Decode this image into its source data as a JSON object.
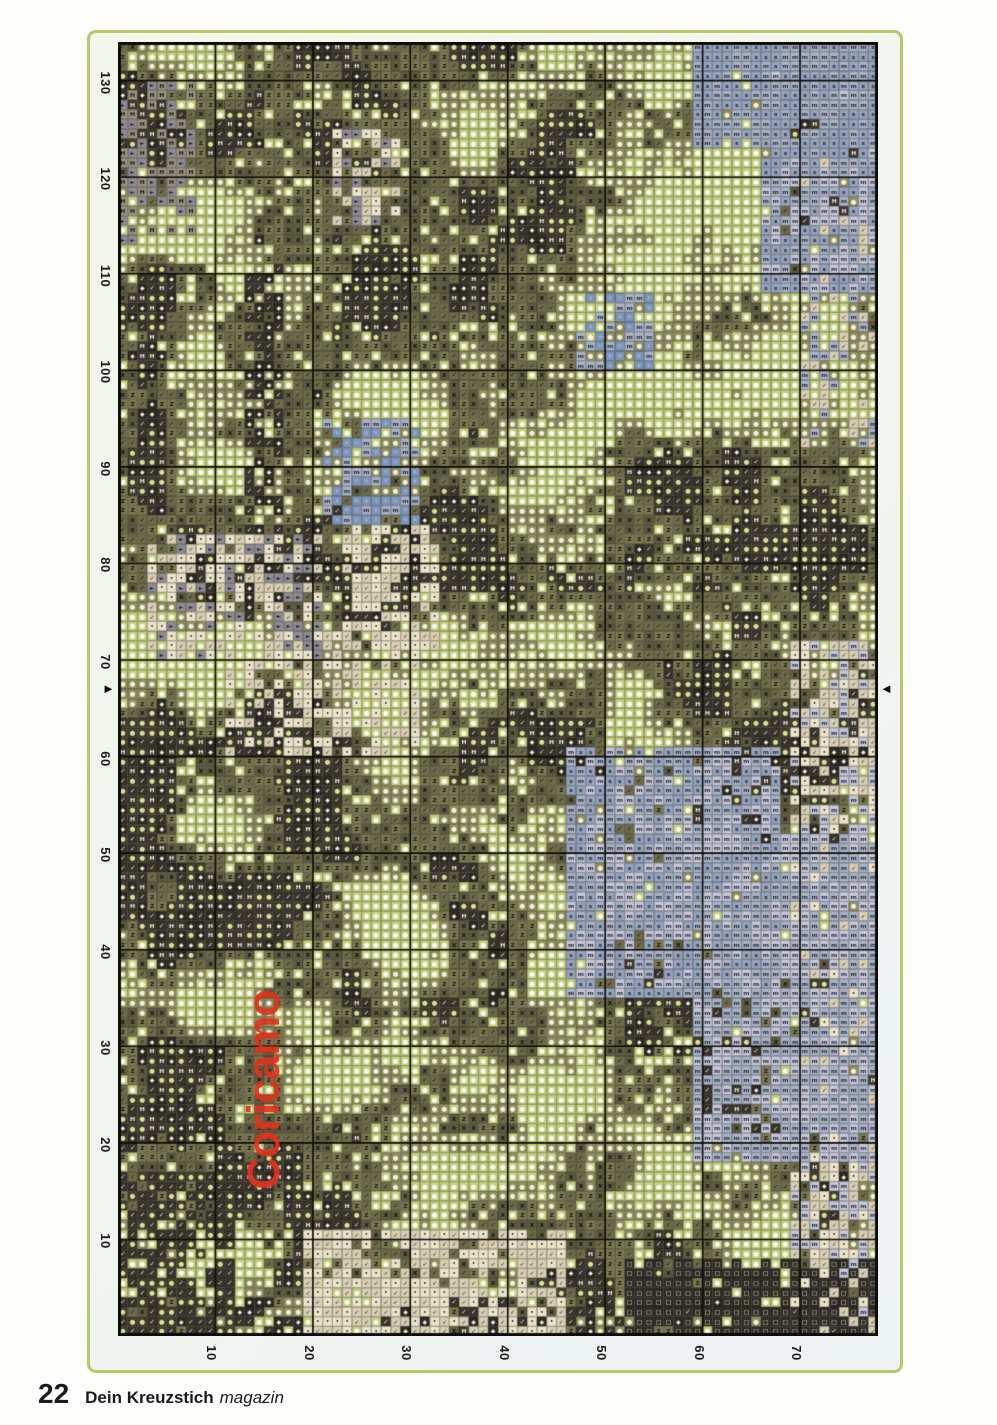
{
  "page": {
    "footer": {
      "number": "22",
      "title": "Dein Kreuzstich",
      "suffix": "magazin"
    }
  },
  "frame": {
    "border_color": "#b5cb67"
  },
  "watermark": {
    "text": "Coricamo",
    "color": "#e2301b"
  },
  "chart": {
    "rows": 134,
    "cols": 78,
    "row_labels": [
      "130",
      "120",
      "110",
      "100",
      "90",
      "80",
      "70",
      "60",
      "50",
      "40",
      "30",
      "20",
      "10"
    ],
    "col_labels": [
      "10",
      "20",
      "30",
      "40",
      "50",
      "60",
      "70"
    ],
    "center_row": 67,
    "center_marker_left": "►",
    "center_marker_right": "◄",
    "grid_color": "#0d0d08",
    "seed": 11,
    "palette": [
      {
        "bg": "#37332a",
        "fg": "#efeadb",
        "sym": "✓",
        "fs": 6.5
      },
      {
        "bg": "#2c2922",
        "fg": "#efeadb",
        "sym": "◆",
        "fs": 6
      },
      {
        "bg": "#433e2e",
        "fg": "#d9e49a",
        "sym": "●",
        "fs": 6.5
      },
      {
        "bg": "#6d6b49",
        "fg": "#14120d",
        "sym": "✓",
        "fs": 6.5
      },
      {
        "bg": "#7b7952",
        "fg": "#14120d",
        "sym": "Z",
        "fs": 6
      },
      {
        "bg": "#5d5b40",
        "fg": "#14120d",
        "sym": "X",
        "fs": 6
      },
      {
        "bg": "#91905f",
        "fg": "#f3f3df",
        "sym": "●",
        "fs": 6.5
      },
      {
        "bg": "#c5d17e",
        "fg": "#ffffff",
        "sym": "●",
        "fs": 6.5
      },
      {
        "bg": "#8d8a92",
        "fg": "#191820",
        "sym": "►",
        "fs": 5.5
      },
      {
        "bg": "#a9b2c6",
        "fg": "#23293a",
        "sym": "m",
        "fs": 6
      },
      {
        "bg": "#c6c7d9",
        "fg": "#23293a",
        "sym": "m",
        "fs": 6
      },
      {
        "bg": "#96a3bd",
        "fg": "#1d2433",
        "sym": "s",
        "fs": 6
      },
      {
        "bg": "#ebe3ca",
        "fg": "#2a261d",
        "sym": "•",
        "fs": 5
      },
      {
        "bg": "#d8cfb4",
        "fg": "#2a261d",
        "sym": "✓",
        "fs": 6
      },
      {
        "bg": "#7e95ba",
        "fg": "#f0f2f6",
        "sym": "◦",
        "fs": 6
      },
      {
        "bg": "#9a9280",
        "fg": "#15130f",
        "sym": "H",
        "fs": 6
      },
      {
        "bg": "#2e2b24",
        "fg": "#f5f2e8",
        "sym": "□",
        "fs": 6
      },
      {
        "bg": "#3d382e",
        "fg": "#efeadb",
        "sym": "H",
        "fs": 6
      }
    ],
    "regions": [
      {
        "c0": 52,
        "r0": 126,
        "c1": 78,
        "r1": 134,
        "d": 0.8,
        "p": [
          16
        ]
      },
      {
        "c0": 0,
        "r0": 117,
        "c1": 12,
        "r1": 134,
        "d": 0.7,
        "p": [
          2,
          0
        ]
      },
      {
        "c0": 59,
        "r0": 0,
        "c1": 78,
        "r1": 11,
        "d": 0.9,
        "p": [
          9,
          11
        ]
      },
      {
        "c0": 66,
        "r0": 0,
        "c1": 78,
        "r1": 26,
        "d": 0.85,
        "p": [
          9,
          11,
          10
        ]
      },
      {
        "c0": 46,
        "r0": 73,
        "c1": 68,
        "r1": 99,
        "d": 0.85,
        "p": [
          10,
          9,
          11
        ]
      },
      {
        "c0": 59,
        "r0": 82,
        "c1": 78,
        "r1": 116,
        "d": 0.8,
        "p": [
          10,
          9
        ]
      },
      {
        "c0": 69,
        "r0": 62,
        "c1": 78,
        "r1": 134,
        "d": 0.7,
        "p": [
          12,
          13,
          10
        ]
      },
      {
        "c0": 19,
        "r0": 123,
        "c1": 46,
        "r1": 134,
        "d": 0.75,
        "p": [
          12,
          13
        ]
      },
      {
        "c0": 3,
        "r0": 51,
        "c1": 21,
        "r1": 64,
        "d": 0.6,
        "p": [
          12,
          13,
          8
        ]
      },
      {
        "c0": 11,
        "r0": 61,
        "c1": 31,
        "r1": 74,
        "d": 0.5,
        "p": [
          13,
          12
        ]
      },
      {
        "c0": 22,
        "r0": 9,
        "c1": 29,
        "r1": 19,
        "d": 0.55,
        "p": [
          13,
          12,
          8
        ]
      },
      {
        "c0": 23,
        "r0": 50,
        "c1": 33,
        "r1": 63,
        "d": 0.55,
        "p": [
          12,
          13
        ]
      },
      {
        "c0": 21,
        "r0": 39,
        "c1": 31,
        "r1": 50,
        "d": 0.6,
        "p": [
          14,
          9
        ]
      },
      {
        "c0": 47,
        "r0": 26,
        "c1": 55,
        "r1": 34,
        "d": 0.5,
        "p": [
          14,
          9
        ]
      },
      {
        "c0": 0,
        "r0": 4,
        "c1": 8,
        "r1": 21,
        "d": 0.5,
        "p": [
          8,
          15
        ]
      },
      {
        "c0": 13,
        "r0": 20,
        "c1": 17,
        "r1": 60,
        "d": 0.5,
        "p": [
          0,
          1
        ]
      },
      {
        "c0": 70,
        "r0": 11,
        "c1": 78,
        "r1": 42,
        "d": 0.55,
        "p": [
          9,
          6,
          13
        ]
      },
      {
        "c0": 0,
        "r0": 130,
        "c1": 78,
        "r1": 134,
        "d": 0.5,
        "p": [
          0,
          1
        ]
      }
    ]
  }
}
